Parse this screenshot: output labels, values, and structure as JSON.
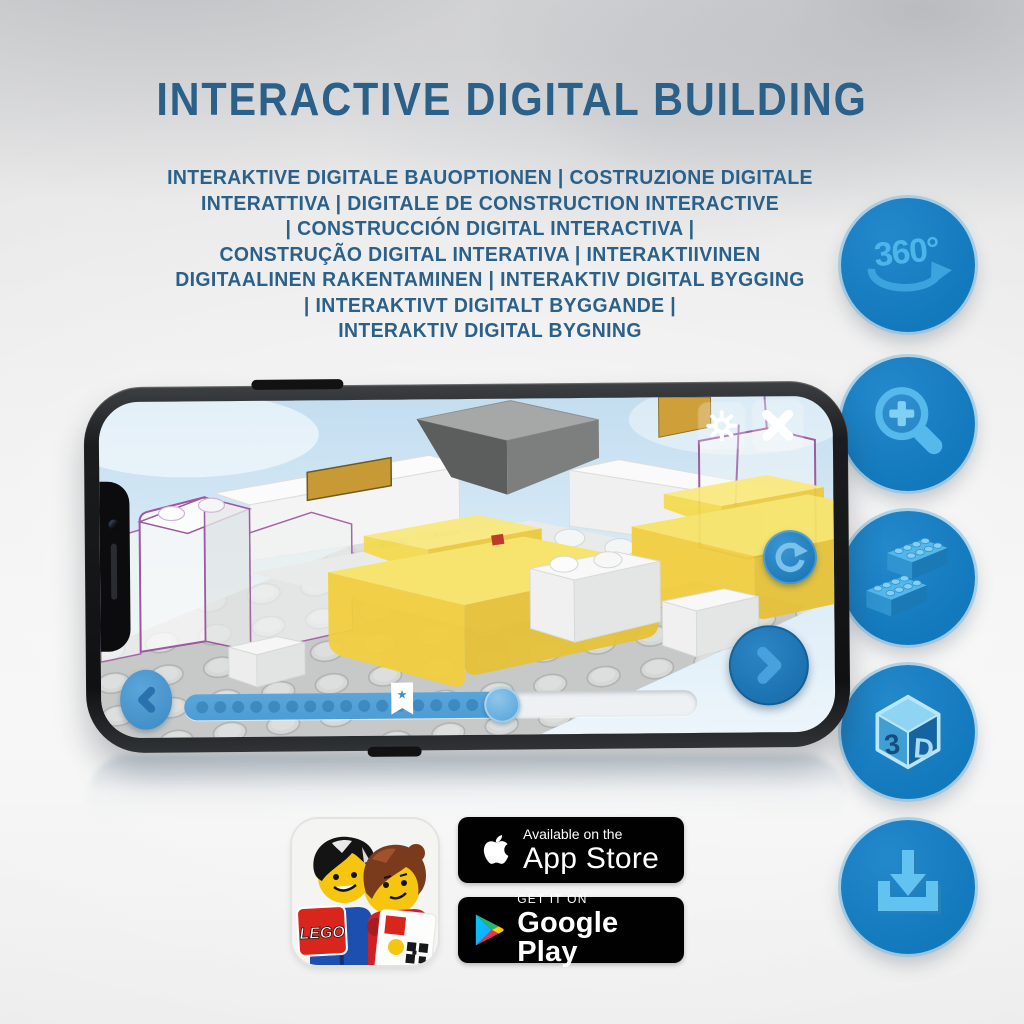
{
  "header": {
    "title": "INTERACTIVE DIGITAL BUILDING",
    "subtitle_lines": [
      "INTERAKTIVE DIGITALE BAUOPTIONEN | COSTRUZIONE DIGITALE",
      "INTERATTIVA | DIGITALE DE CONSTRUCTION INTERACTIVE",
      "| CONSTRUCCIÓN DIGITAL INTERACTIVA |",
      "CONSTRUÇÃO DIGITAL INTERATIVA | INTERAKTIIVINEN",
      "DIGITAALINEN RAKENTAMINEN | INTERAKTIV DIGITAL BYGGING",
      "| INTERAKTIVT DIGITALT BYGGANDE |",
      "INTERAKTIV DIGITAL BYGNING"
    ]
  },
  "features": [
    {
      "icon": "360-rotate-icon",
      "label": "360°"
    },
    {
      "icon": "zoom-in-icon"
    },
    {
      "icon": "brick-icon"
    },
    {
      "icon": "3d-cube-icon",
      "label_left": "3",
      "label_right": "D"
    },
    {
      "icon": "download-icon"
    }
  ],
  "phone": {
    "screen_icons": [
      "gear-icon",
      "close-icon",
      "rotate-icon",
      "chevron-left-icon",
      "chevron-right-icon"
    ],
    "slider": {
      "progress_pct": 62,
      "bookmark_pct": 42.5,
      "dot_count": 17,
      "bookmark_glyph": "★"
    }
  },
  "badges": {
    "app_store": {
      "line1": "Available on the",
      "line2": "App Store"
    },
    "google_play": {
      "line1": "GET IT ON",
      "line2": "Google Play"
    },
    "lego_logo": "LEGO"
  },
  "colors": {
    "heading_text": "#2b6089",
    "circle_fill": "#1379bd",
    "circle_glyph": "#58bbee",
    "slider_fill": "#4d9cd4",
    "badge_bg": "#010101",
    "phone_sky": "#cde5f3",
    "yellow_brick": "#f2cf3e"
  }
}
